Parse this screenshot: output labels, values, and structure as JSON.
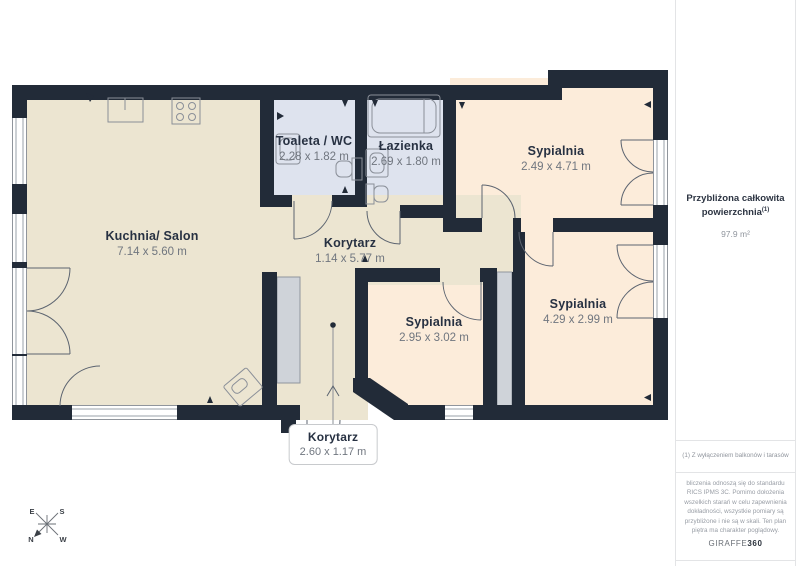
{
  "plan": {
    "rooms": [
      {
        "name": "Kuchnia/ Salon",
        "dims": "7.14 x 5.60 m"
      },
      {
        "name": "Toaleta / WC",
        "dims": "2.28 x 1.82 m"
      },
      {
        "name": "Łazienka",
        "dims": "2.69 x 1.80 m"
      },
      {
        "name": "Sypialnia",
        "dims": "2.49 x 4.71 m"
      },
      {
        "name": "Korytarz",
        "dims": "1.14 x 5.77 m"
      },
      {
        "name": "Sypialnia",
        "dims": "2.95 x 3.02 m"
      },
      {
        "name": "Sypialnia",
        "dims": "4.29 x 2.99 m"
      },
      {
        "name": "Korytarz",
        "dims": "2.60 x 1.17 m"
      }
    ],
    "compass": {
      "top_left": "E",
      "top_right": "S",
      "bottom_left": "N",
      "bottom_right": "W"
    }
  },
  "sidebar": {
    "area_title_line1": "Przybliżona całkowita",
    "area_title_line2": "powierzchnia",
    "area_title_superscript": "(1)",
    "area_value": "97.9 m²",
    "footnote": "(1) Z wyłączeniem balkonów i tarasów",
    "disclaimer": "bliczenia odnoszą się do standardu RICS IPMS 3C. Pomimo dołożenia wszelkich starań w celu zapewnienia dokładności, wszystkie pomiary są przybliżone i nie są w skali. Ten plan piętra ma charakter poglądowy.",
    "logo_text": "GIRAFFE",
    "logo_bold": "360"
  },
  "colors": {
    "wall": "#222b38",
    "floor_main": "#ece5d1",
    "floor_bedroom": "#fcecda",
    "floor_bath": "#dee3ee",
    "shaft_gray": "#cfd3d9",
    "arc_stroke": "#5c6470"
  }
}
